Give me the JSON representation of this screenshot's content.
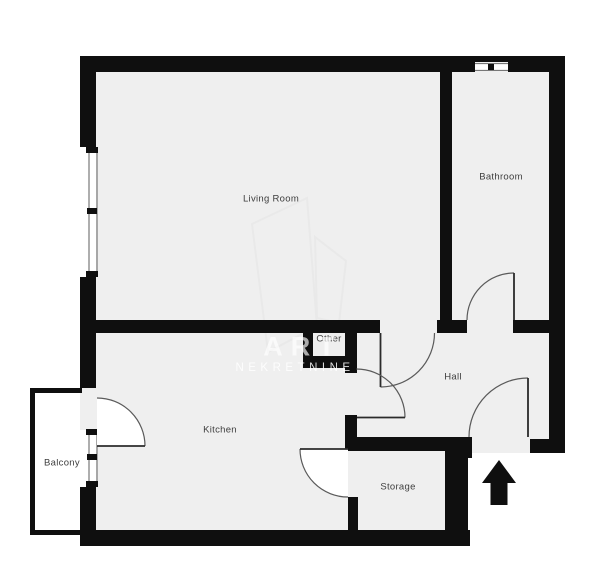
{
  "plan_title": "Apartment floor plan",
  "rooms": {
    "living_room": "Living Room",
    "bathroom": "Bathroom",
    "other": "Other",
    "hall": "Hall",
    "kitchen": "Kitchen",
    "balcony": "Balcony",
    "storage": "Storage"
  },
  "watermark": {
    "line1": "ART",
    "line2": "NEKRETNINE"
  },
  "colors": {
    "wall": "#0f0f0f",
    "floor": "#efefef",
    "outside": "#ffffff",
    "label_text": "#3e3e3e",
    "door_arc": "#5a5a5a",
    "door_leaf": "#2b2b2b",
    "window_line": "#777777",
    "watermark_logo": "#e9e9e9",
    "entrance_arrow": "#0f0f0f"
  },
  "icons": {
    "entrance_arrow": "up-arrow-entrance-marker",
    "watermark_logo": "art-nekretnine-logo-outline"
  }
}
